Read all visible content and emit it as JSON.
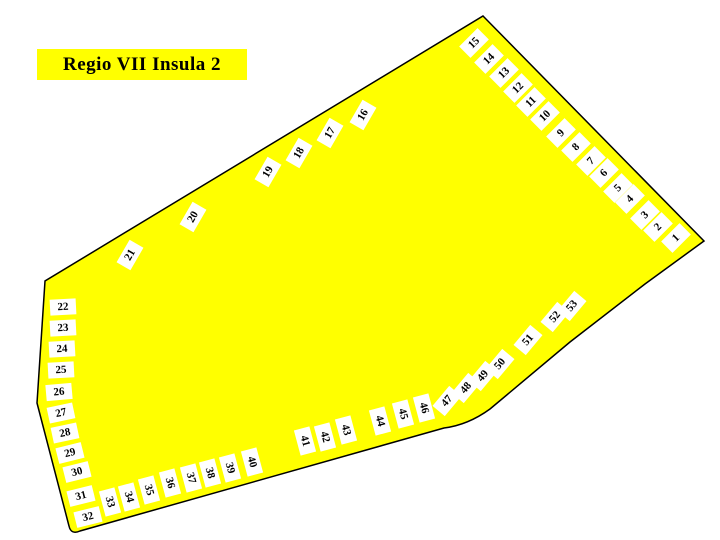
{
  "title": {
    "label": "Regio VII Insula 2"
  },
  "map": {
    "name": "insula-plan",
    "fill_color": "#FFFF00",
    "outline_color": "#000000",
    "entrance_box_color": "#FFFFFF",
    "outline_path": "M 483 16 L 704 241 L 645 284 L 570 342 L 490 409 Q 468 425 444 428 L 80 531 Q 71 535 69 526 L 37 403 L 45 281 Z"
  },
  "entrances": [
    {
      "n": "1",
      "x": 676,
      "y": 238,
      "r": -45
    },
    {
      "n": "2",
      "x": 658,
      "y": 227,
      "r": -45
    },
    {
      "n": "3",
      "x": 645,
      "y": 215,
      "r": -45
    },
    {
      "n": "4",
      "x": 630,
      "y": 199,
      "r": -45
    },
    {
      "n": "5",
      "x": 618,
      "y": 188,
      "r": -45
    },
    {
      "n": "6",
      "x": 604,
      "y": 173,
      "r": -45
    },
    {
      "n": "7",
      "x": 591,
      "y": 161,
      "r": -45
    },
    {
      "n": "8",
      "x": 576,
      "y": 147,
      "r": -45
    },
    {
      "n": "9",
      "x": 561,
      "y": 133,
      "r": -45
    },
    {
      "n": "10",
      "x": 545,
      "y": 116,
      "r": -45
    },
    {
      "n": "11",
      "x": 531,
      "y": 102,
      "r": -45
    },
    {
      "n": "12",
      "x": 518,
      "y": 88,
      "r": -45
    },
    {
      "n": "13",
      "x": 504,
      "y": 73,
      "r": -45
    },
    {
      "n": "14",
      "x": 489,
      "y": 59,
      "r": -45
    },
    {
      "n": "15",
      "x": 474,
      "y": 43,
      "r": -45
    },
    {
      "n": "16",
      "x": 363,
      "y": 115,
      "r": -60
    },
    {
      "n": "17",
      "x": 330,
      "y": 133,
      "r": -60
    },
    {
      "n": "18",
      "x": 299,
      "y": 153,
      "r": -60
    },
    {
      "n": "19",
      "x": 268,
      "y": 172,
      "r": -60
    },
    {
      "n": "20",
      "x": 193,
      "y": 217,
      "r": -60
    },
    {
      "n": "21",
      "x": 130,
      "y": 255,
      "r": -60
    },
    {
      "n": "22",
      "x": 63,
      "y": 307,
      "r": -3
    },
    {
      "n": "23",
      "x": 63,
      "y": 328,
      "r": -3
    },
    {
      "n": "24",
      "x": 62,
      "y": 349,
      "r": -3
    },
    {
      "n": "25",
      "x": 61,
      "y": 370,
      "r": -3
    },
    {
      "n": "26",
      "x": 59,
      "y": 392,
      "r": -5
    },
    {
      "n": "27",
      "x": 61,
      "y": 413,
      "r": -12
    },
    {
      "n": "28",
      "x": 65,
      "y": 433,
      "r": -12
    },
    {
      "n": "29",
      "x": 70,
      "y": 453,
      "r": -14
    },
    {
      "n": "30",
      "x": 77,
      "y": 472,
      "r": -14
    },
    {
      "n": "31",
      "x": 81,
      "y": 496,
      "r": -14
    },
    {
      "n": "32",
      "x": 88,
      "y": 517,
      "r": -14
    },
    {
      "n": "33",
      "x": 110,
      "y": 502,
      "r": 75
    },
    {
      "n": "34",
      "x": 129,
      "y": 497,
      "r": 75
    },
    {
      "n": "35",
      "x": 149,
      "y": 490,
      "r": 75
    },
    {
      "n": "36",
      "x": 170,
      "y": 483,
      "r": 75
    },
    {
      "n": "37",
      "x": 191,
      "y": 478,
      "r": 75
    },
    {
      "n": "38",
      "x": 210,
      "y": 473,
      "r": 75
    },
    {
      "n": "39",
      "x": 230,
      "y": 468,
      "r": 75
    },
    {
      "n": "40",
      "x": 252,
      "y": 462,
      "r": 75
    },
    {
      "n": "41",
      "x": 305,
      "y": 441,
      "r": 75
    },
    {
      "n": "42",
      "x": 325,
      "y": 437,
      "r": 75
    },
    {
      "n": "43",
      "x": 346,
      "y": 430,
      "r": 75
    },
    {
      "n": "44",
      "x": 380,
      "y": 421,
      "r": 75
    },
    {
      "n": "45",
      "x": 403,
      "y": 414,
      "r": 75
    },
    {
      "n": "46",
      "x": 424,
      "y": 408,
      "r": 75
    },
    {
      "n": "47",
      "x": 447,
      "y": 401,
      "r": -50
    },
    {
      "n": "48",
      "x": 466,
      "y": 388,
      "r": -50
    },
    {
      "n": "49",
      "x": 483,
      "y": 376,
      "r": -50
    },
    {
      "n": "50",
      "x": 500,
      "y": 364,
      "r": -50
    },
    {
      "n": "51",
      "x": 528,
      "y": 340,
      "r": -50
    },
    {
      "n": "52",
      "x": 555,
      "y": 317,
      "r": -50
    },
    {
      "n": "53",
      "x": 572,
      "y": 306,
      "r": -50
    }
  ]
}
